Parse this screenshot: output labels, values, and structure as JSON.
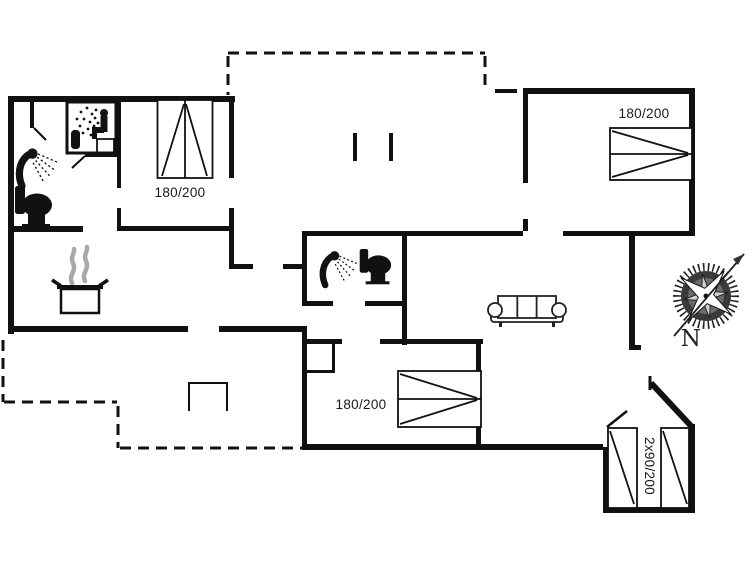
{
  "floor_plan": {
    "beds": {
      "top_left": "180/200",
      "top_right": "180/200",
      "bottom_middle": "180/200",
      "bottom_right": "2x90/200"
    },
    "compass": {
      "north": "N"
    },
    "colors": {
      "wall": "#111111",
      "background": "#ffffff",
      "steam": "#a8a8a8",
      "compass_disk": "#3a3a3a"
    },
    "icons": {
      "sauna": "sauna-icon",
      "shower_main_bath": "shower-icon",
      "toilet_main_bath": "toilet-icon",
      "shower_second_bath": "shower-icon",
      "toilet_second_bath": "toilet-icon",
      "cooking_pot": "cooking-pot-icon",
      "sofa": "sofa-icon",
      "compass_rose": "compass-rose-icon",
      "fireplace": "fireplace-outline",
      "terrace": "terrace-dashed-outline"
    }
  }
}
